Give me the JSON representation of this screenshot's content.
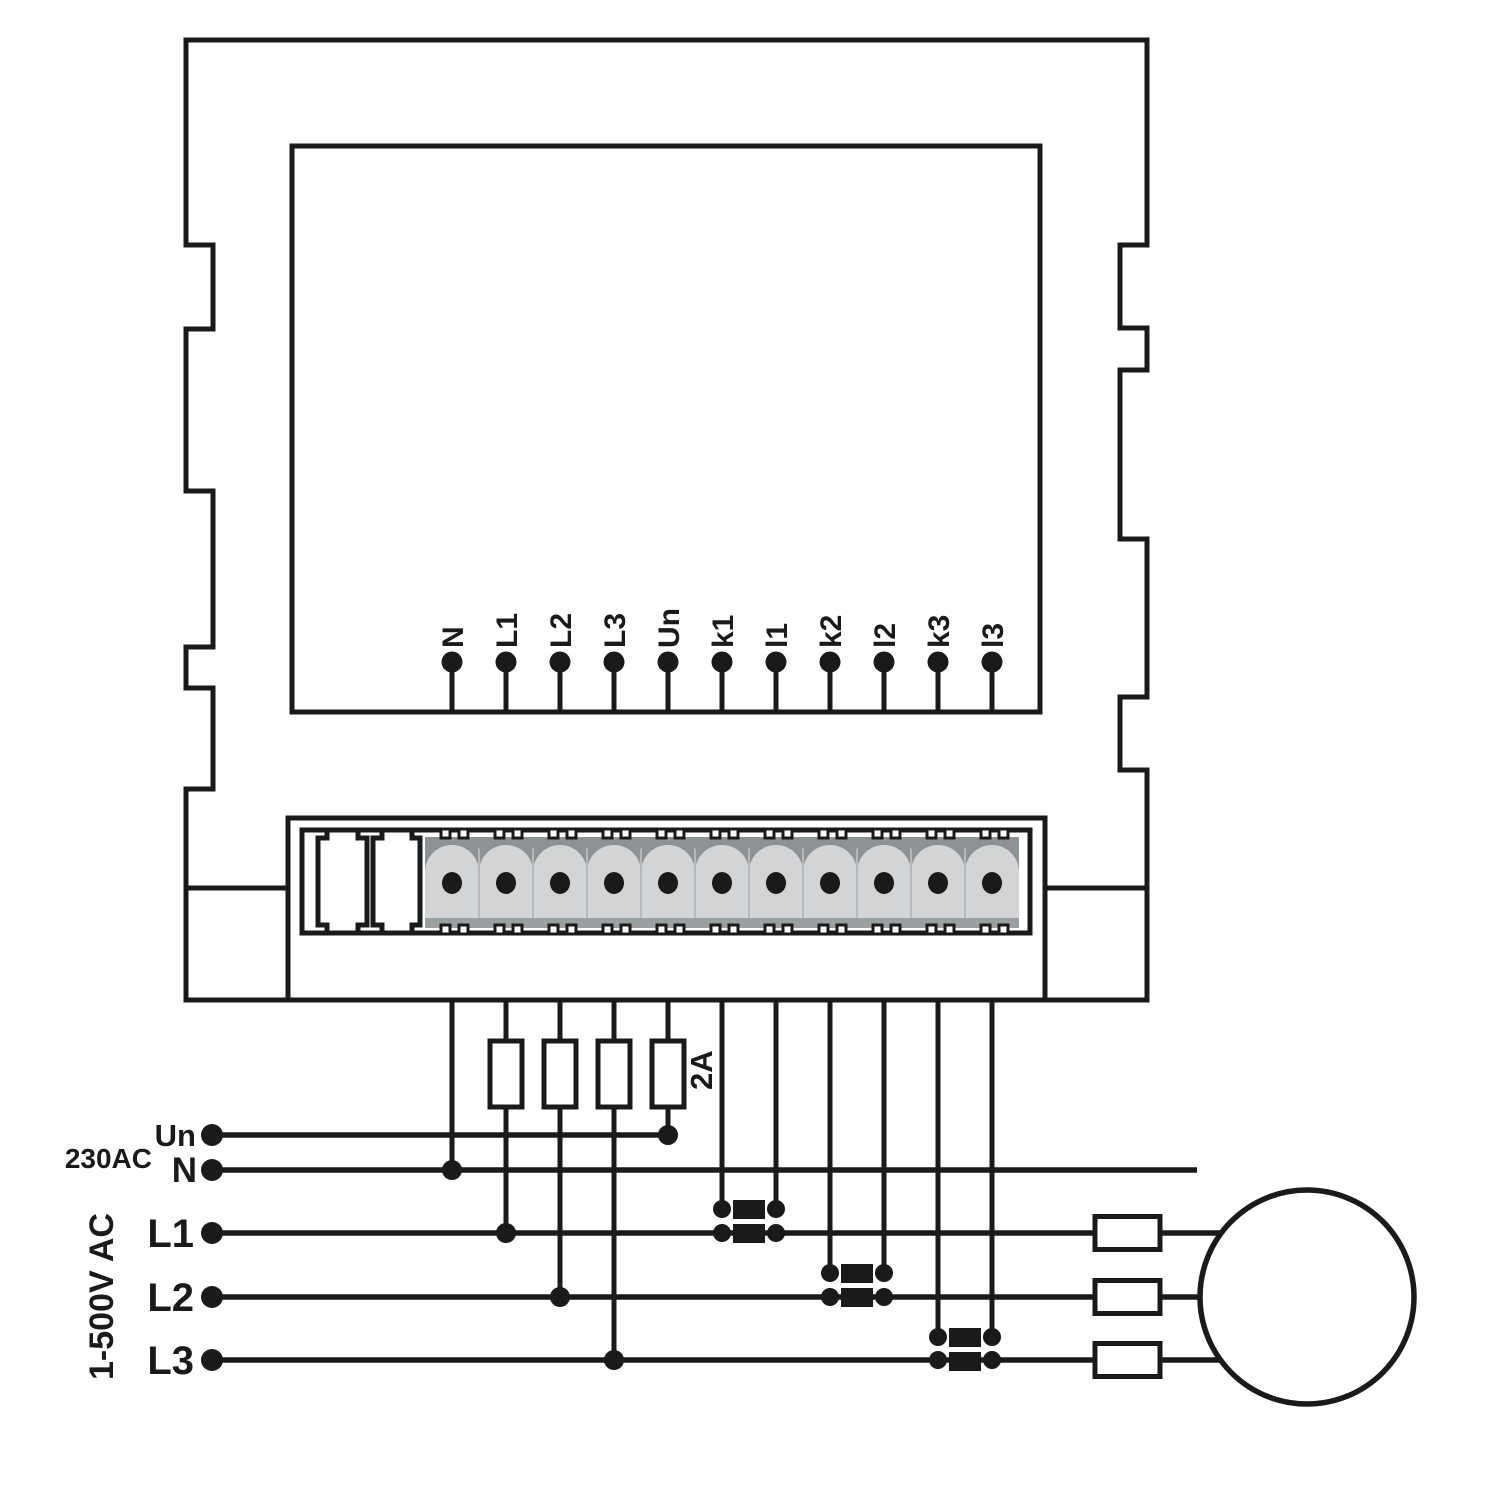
{
  "device": {
    "terminal_labels": [
      "N",
      "L1",
      "L2",
      "L3",
      "Un",
      "k1",
      "l1",
      "k2",
      "l2",
      "k3",
      "l3"
    ]
  },
  "fuses": {
    "rating_label": "2A"
  },
  "supply": {
    "un_label": "Un",
    "neutral_label": "N",
    "voltage_label": "230AC",
    "range_label": "1-500V AC",
    "phase_labels": [
      "L1",
      "L2",
      "L3"
    ]
  },
  "colors": {
    "line": "#1a1a1a",
    "strip_dark": "#8d9294",
    "strip_light": "#d2d4d5",
    "strip_band": "#9aa0a2",
    "strip_divider": "#b5b9bb"
  }
}
